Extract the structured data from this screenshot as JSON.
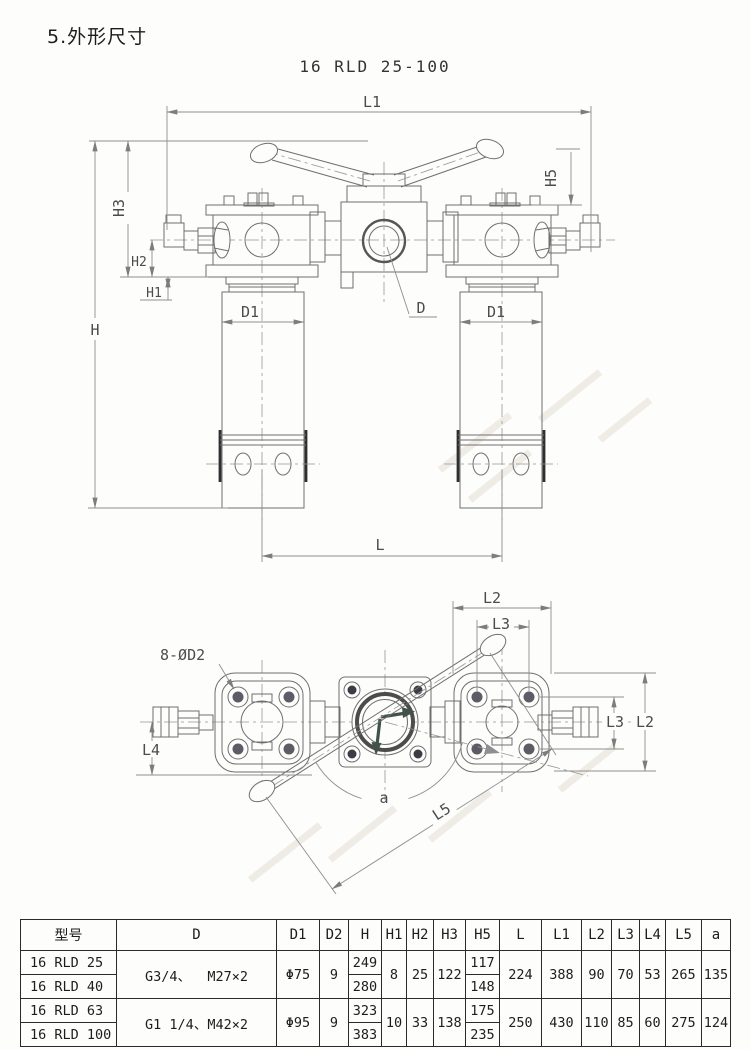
{
  "page": {
    "title": "5.外形尺寸",
    "model_heading": "16 RLD 25-100"
  },
  "front_view": {
    "labels": {
      "l1": "L1",
      "h5": "H5",
      "h3": "H3",
      "h2": "H2",
      "h1": "H1",
      "h": "H",
      "d1_left": "D1",
      "d1_right": "D1",
      "d": "D",
      "l": "L"
    }
  },
  "top_view": {
    "labels": {
      "bolt_callout": "8-ØD2",
      "l2_top": "L2",
      "l3_top": "L3",
      "l3_right": "L3",
      "l2_right": "L2",
      "l4": "L4",
      "angle": "a",
      "l5": "L5"
    }
  },
  "table": {
    "headers": [
      "型号",
      "D",
      "D1",
      "D2",
      "H",
      "H1",
      "H2",
      "H3",
      "H5",
      "L",
      "L1",
      "L2",
      "L3",
      "L4",
      "L5",
      "a"
    ],
    "groups": [
      {
        "models": [
          "16 RLD 25",
          "16 RLD 40"
        ],
        "d": "G3/4、  M27×2",
        "d1": "Φ75",
        "d2": "9",
        "h": [
          "249",
          "280"
        ],
        "h1": "8",
        "h2": "25",
        "h3": "122",
        "h5": [
          "117",
          "148"
        ],
        "l": "224",
        "l1": "388",
        "l2": "90",
        "l3": "70",
        "l4": "53",
        "l5": "265",
        "a": "135"
      },
      {
        "models": [
          "16 RLD 63",
          "16 RLD 100"
        ],
        "d": "G1 1/4、M42×2",
        "d1": "Φ95",
        "d2": "9",
        "h": [
          "323",
          "383"
        ],
        "h1": "10",
        "h2": "33",
        "h3": "138",
        "h5": [
          "175",
          "235"
        ],
        "l": "250",
        "l1": "430",
        "l2": "110",
        "l3": "85",
        "l4": "60",
        "l5": "275",
        "a": "124"
      }
    ]
  }
}
